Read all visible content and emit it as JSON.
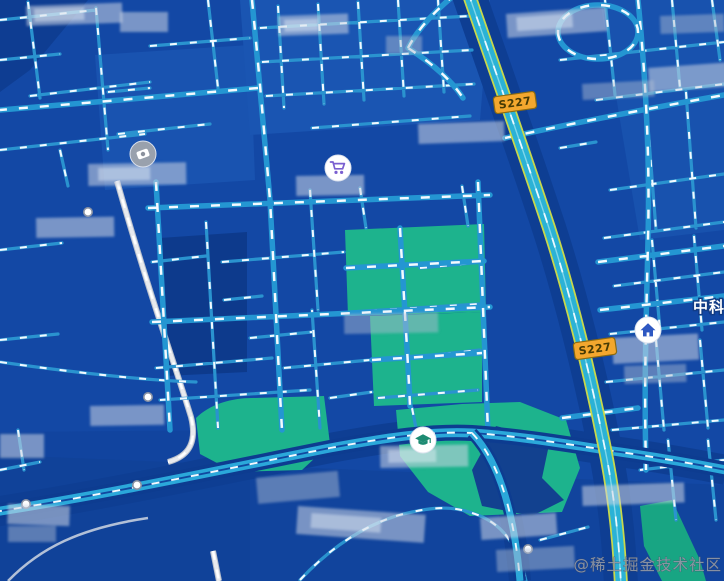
{
  "map": {
    "watermark_text": "@稀土掘金技术社区",
    "edge_place_label": "中科",
    "road_badges": [
      {
        "label": "S227"
      },
      {
        "label": "S227"
      }
    ],
    "pois": [
      {
        "icon": "shopping-cart-icon",
        "kind": "shopping"
      },
      {
        "icon": "scenic-marker-icon",
        "kind": "scenic-spot"
      },
      {
        "icon": "house-icon",
        "kind": "residence"
      },
      {
        "icon": "graduation-cap-icon",
        "kind": "school"
      }
    ],
    "colors": {
      "background": "#1348a5",
      "block_light": "#1b57b4",
      "block_dark": "#0d3a8c",
      "park_green": "#1db38d",
      "road_cyan": "#2a93cf",
      "road_dash_white": "#f2f9ff",
      "highway_fill": "#2bb2d6",
      "highway_edge": "#c9d84a",
      "railway_gray": "#e8eaee",
      "badge_bg": "#f3a72e",
      "badge_text": "#463a05"
    }
  }
}
